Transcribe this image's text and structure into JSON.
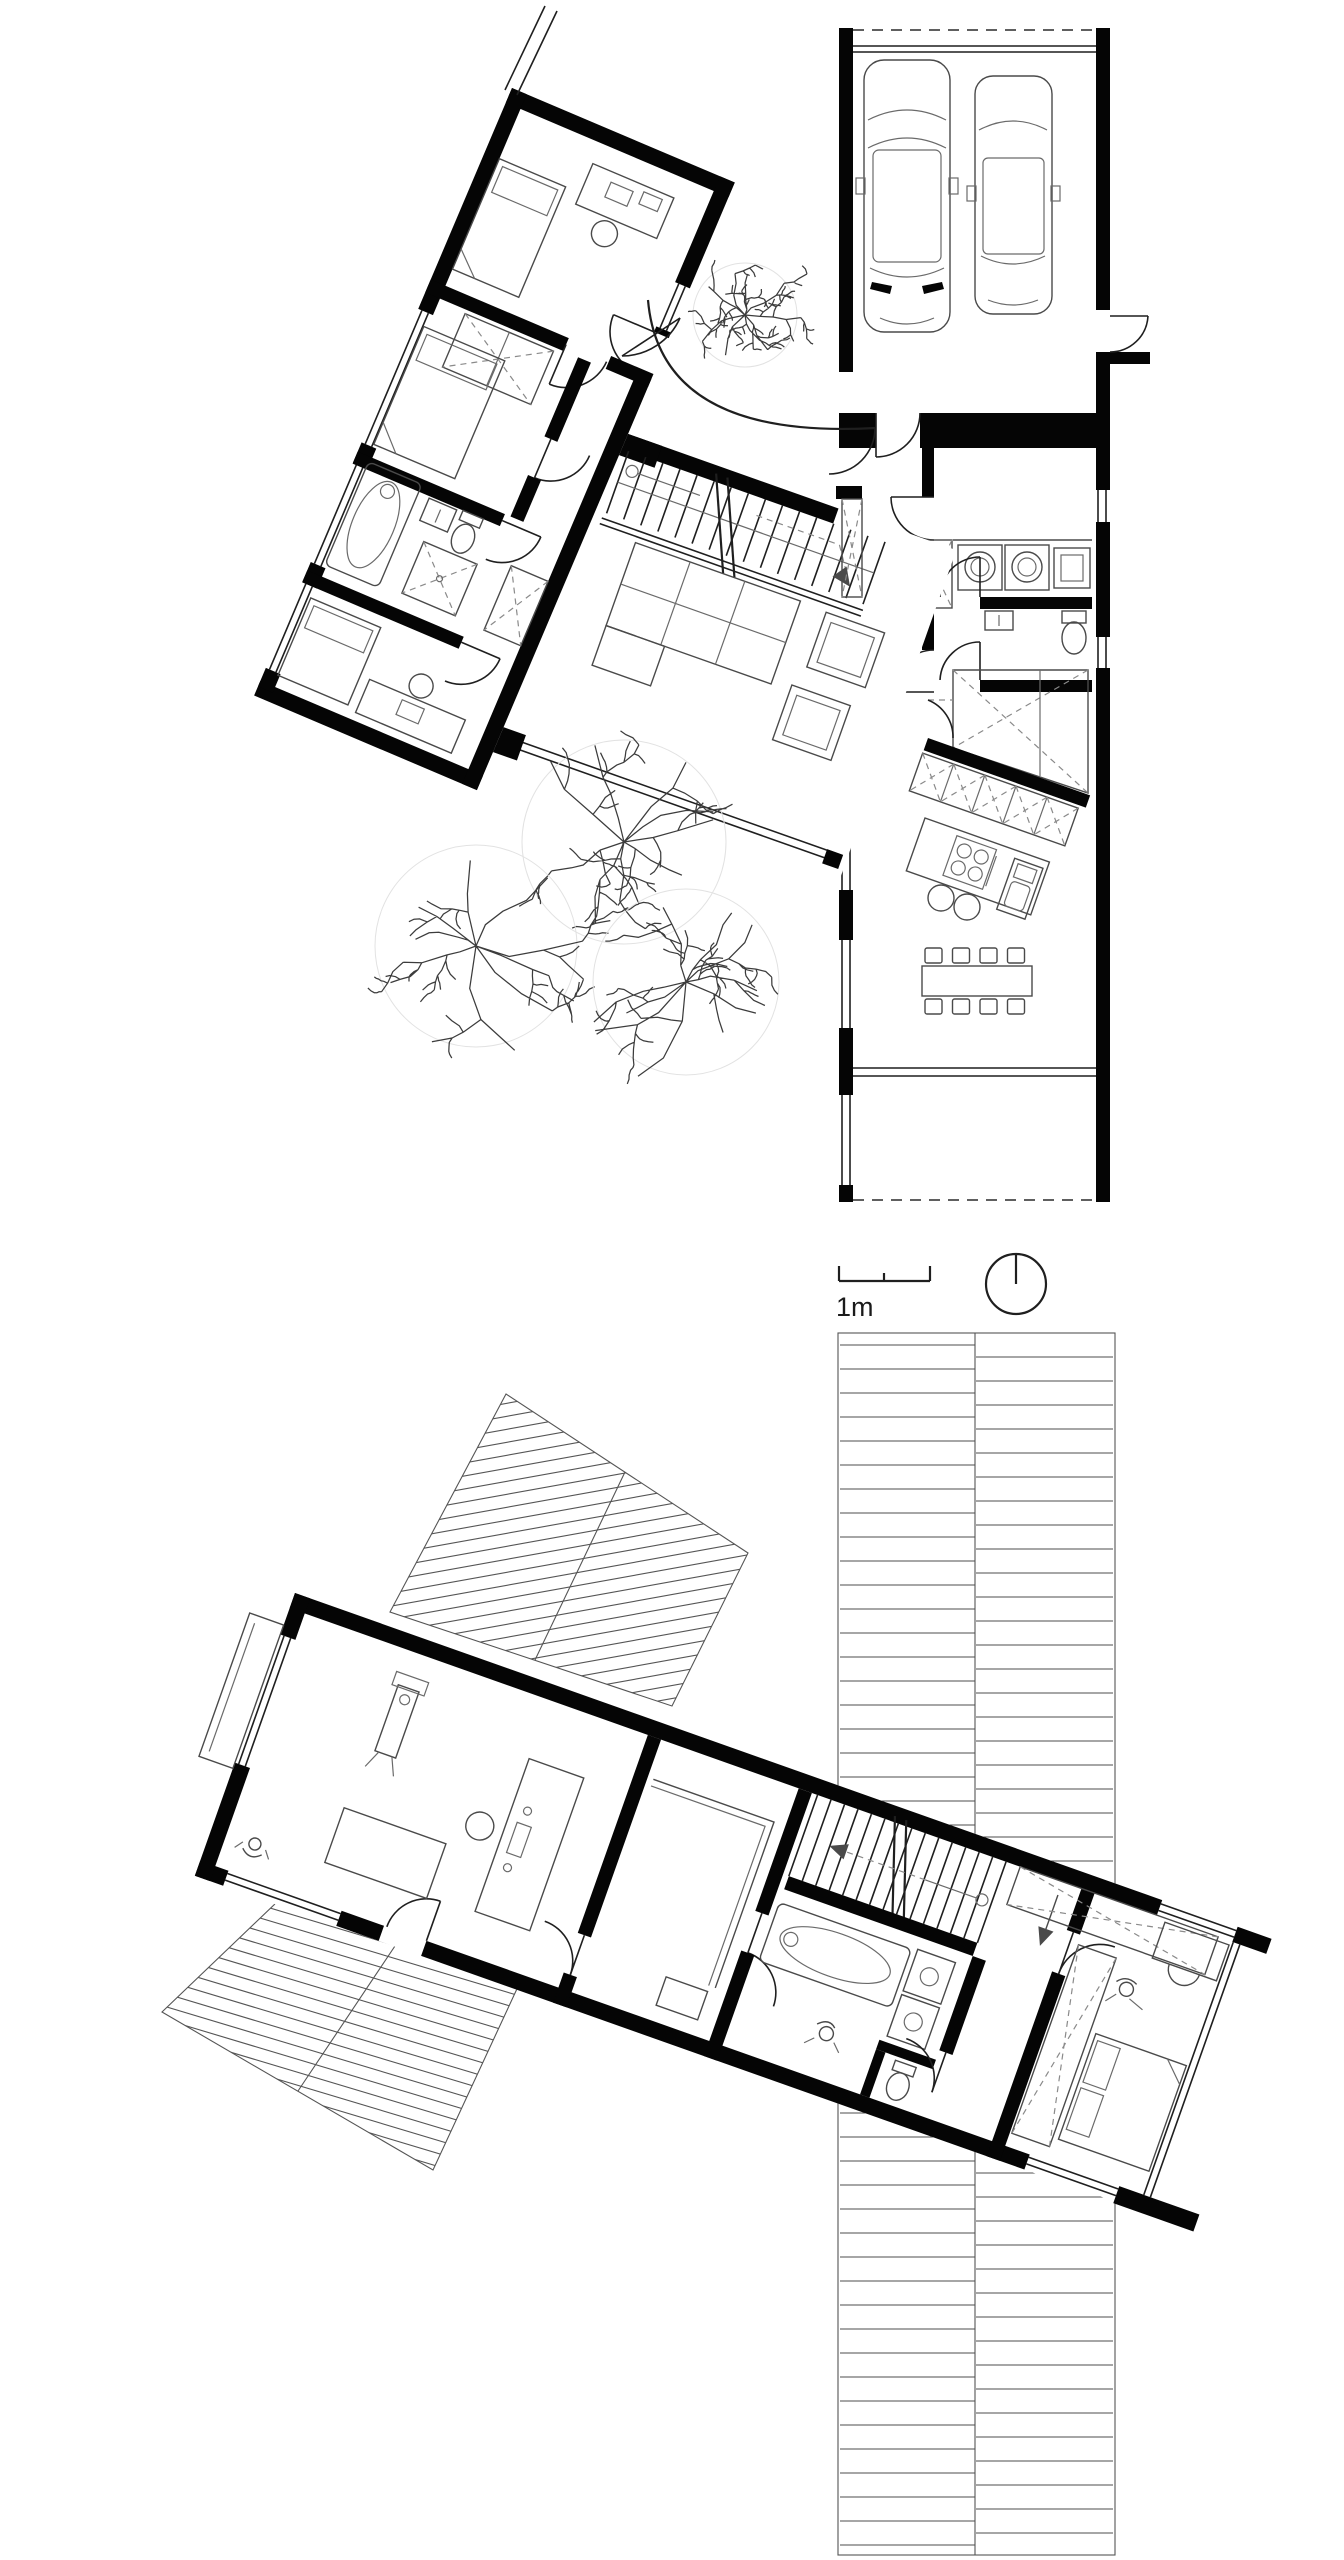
{
  "scale": {
    "label": "1m"
  },
  "colors": {
    "background": "#ffffff",
    "wall": "#050505",
    "line": "#1f1f1f",
    "furniture": "#4a4a4a",
    "hatch": "#555555"
  },
  "floors": [
    {
      "id": "ground-floor",
      "elements": [
        "garage",
        "car",
        "car",
        "laundry-room",
        "wc",
        "pantry",
        "kitchen-cabinets",
        "kitchen-island",
        "dining-table",
        "covered-terrace",
        "living-room",
        "stairs",
        "sofa",
        "armchair",
        "armchair",
        "bedroom-1",
        "bedroom-2",
        "bedroom-3",
        "bathroom",
        "entry-court",
        "curved-wall",
        "walkway",
        "trees"
      ]
    },
    {
      "id": "upper-floor",
      "elements": [
        "office-studio",
        "closet-room",
        "stairs",
        "bathroom",
        "hall",
        "bedroom",
        "wardrobes",
        "roof-deck",
        "roof-panel",
        "roof-panel"
      ]
    }
  ],
  "icons": [
    "car-icon",
    "tree-icon",
    "bed-icon",
    "desk-icon",
    "chair-icon",
    "sofa-icon",
    "armchair-icon",
    "bathtub-icon",
    "sink-icon",
    "toilet-icon",
    "shower-icon",
    "washer-icon",
    "dryer-icon",
    "cooktop-icon",
    "dining-table-icon",
    "stool-icon",
    "wardrobe-x-icon",
    "stairs-icon",
    "door-arc-icon",
    "person-icon",
    "north-arrow-icon",
    "scale-bar-icon"
  ],
  "counts": {
    "cars": 2,
    "trees": 4,
    "dining-chairs": 8
  }
}
